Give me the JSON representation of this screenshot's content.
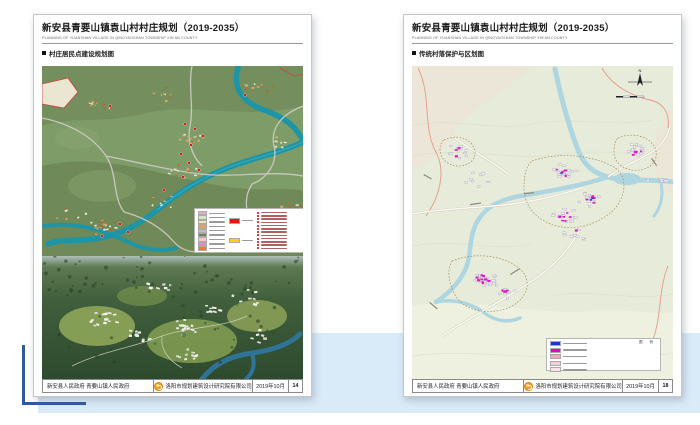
{
  "canvas": {
    "band_color": "#d9eaf8",
    "bracket_color": "#2e5a9e"
  },
  "doc": {
    "title": "新安县青要山镇袁山村村庄规划（2019-2035）",
    "subtitle": "PLANNING OF YUANSHAN VILLAGE IN QINGYAOSHAN TOWNSHIP XIN'AN COUNTY",
    "footer": {
      "gov": "新安县人民政府  青要山镇人民政府",
      "company": "洛阳市规划建筑设计研究院有限公司",
      "date": "2019年10月"
    }
  },
  "left_page": {
    "section": "村庄居民点建设规划图",
    "page_no": "14",
    "legend": {
      "line_swatches": [
        "#f0a8c8",
        "#cfe8c0",
        "#f5e6b0",
        "#f0a050",
        "#c0c0b8",
        "#6e7f4e",
        "#f8c8c8",
        "#f080c0",
        "#f07830"
      ],
      "big_swatches": [
        "#ee1111",
        "#ffd400"
      ],
      "marker_color": "#cc1111",
      "marker_rows": 12
    }
  },
  "right_page": {
    "section": "传统村落保护与区划图",
    "page_no": "18",
    "compass": "N",
    "legend_title": "图 例",
    "legend": {
      "swatches": [
        "#2233cc",
        "#ee00cc",
        "#f0a8b8",
        "#f6cdd8",
        "#f9e4ea"
      ]
    }
  }
}
